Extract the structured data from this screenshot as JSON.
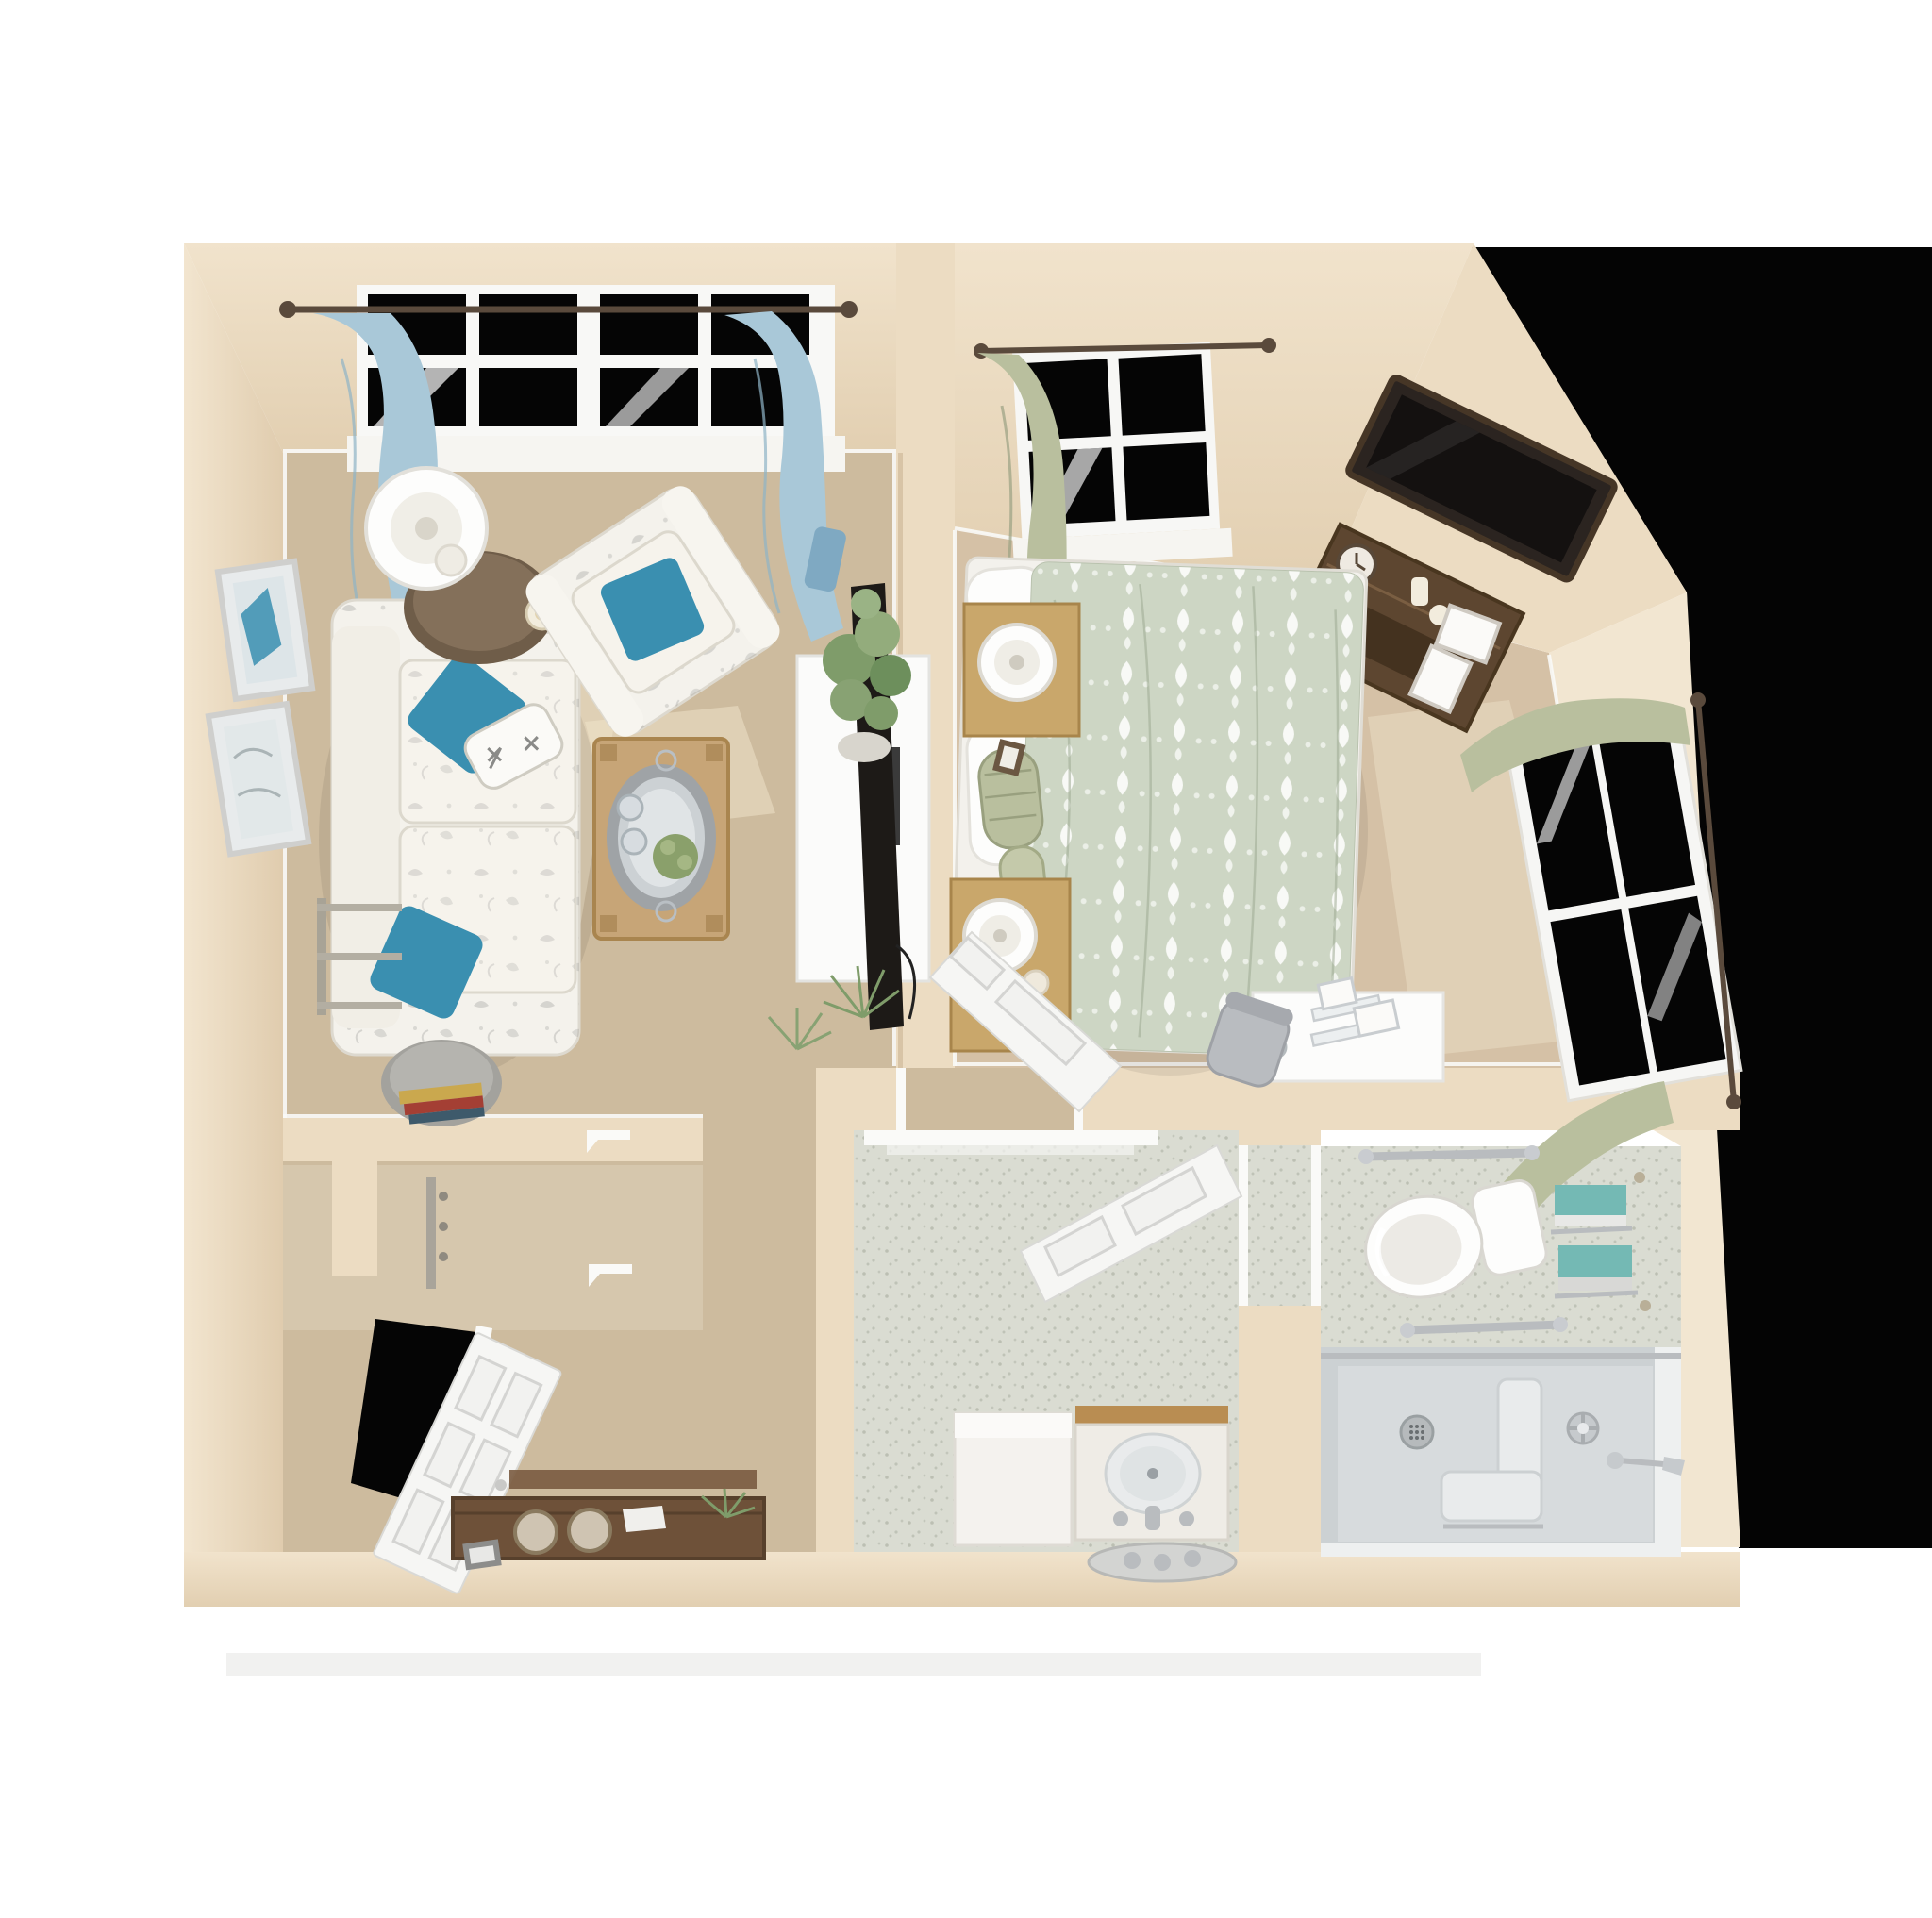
{
  "meta": {
    "image_type": "3d-floor-plan-rendering",
    "view": "top-down dollhouse view of a one-bedroom apartment"
  },
  "colors": {
    "page_bg": "#ffffff",
    "outside": "#040404",
    "wall": "#ecdcc2",
    "wall_light": "#f2e6d1",
    "wall_dark": "#ddc8a9",
    "carpet_living": "#cdbb9e",
    "carpet_bedroom": "#d5c1a6",
    "bath_floor": "#dadcd2",
    "bath_speckle": "#b4b8ab",
    "shower_pan": "#ccd1d3",
    "window_glass": "#050505",
    "curtain_blue": "#a9c8d8",
    "curtain_sage": "#b9bf9e",
    "accent_teal": "#3a8fb0",
    "towel_teal": "#74b9b4",
    "quilt_sage": "#cdd6c4",
    "upholstery": "#f4f2ec",
    "wood_dark": "#5d4630",
    "wood_medium": "#6e5139",
    "wood_light": "#c7a577",
    "door_white": "#f6f6f4",
    "chrome": "#b9bcbf",
    "tv_black": "#1d1a17",
    "fixture_white": "#fdfdfc"
  },
  "rooms": {
    "living_room": {
      "label": "living room",
      "items": [
        "sofa",
        "armchair",
        "teal-throw-pillows",
        "starfish-lumbar-pillow",
        "coffee-table",
        "side-table",
        "table-lamp",
        "drum-end-table",
        "books",
        "wall-mirrors",
        "window-blue-curtains",
        "tv-console",
        "flat-tv",
        "potted-plant",
        "floor-fern",
        "wall-shelves"
      ]
    },
    "bedroom": {
      "label": "bedroom",
      "items": [
        "bed-damask-quilt",
        "white-pillows",
        "sage-bolster",
        "nightstand-lamp",
        "second-nightstand-lamp",
        "dresser-with-clock",
        "wall-mounted-tv",
        "window-sage-curtains",
        "side-window",
        "desk",
        "desk-chair",
        "open-door"
      ]
    },
    "vanity_room": {
      "label": "vanity room",
      "items": [
        "vanity-sink",
        "faucet",
        "storage-cabinet",
        "leaning-oval-tray",
        "open-paneled-door",
        "speckled-floor"
      ]
    },
    "bathroom": {
      "label": "bathroom",
      "items": [
        "toilet",
        "grab-bars",
        "teal-towel-shelves",
        "roll-in-shower",
        "shower-bench",
        "shower-drain",
        "shower-valve",
        "shower-head"
      ]
    },
    "entry": {
      "label": "entry",
      "items": [
        "open-front-door",
        "dark-doorway",
        "wood-console-bench",
        "round-knobs",
        "closet-rod",
        "shelf-brackets"
      ]
    }
  }
}
